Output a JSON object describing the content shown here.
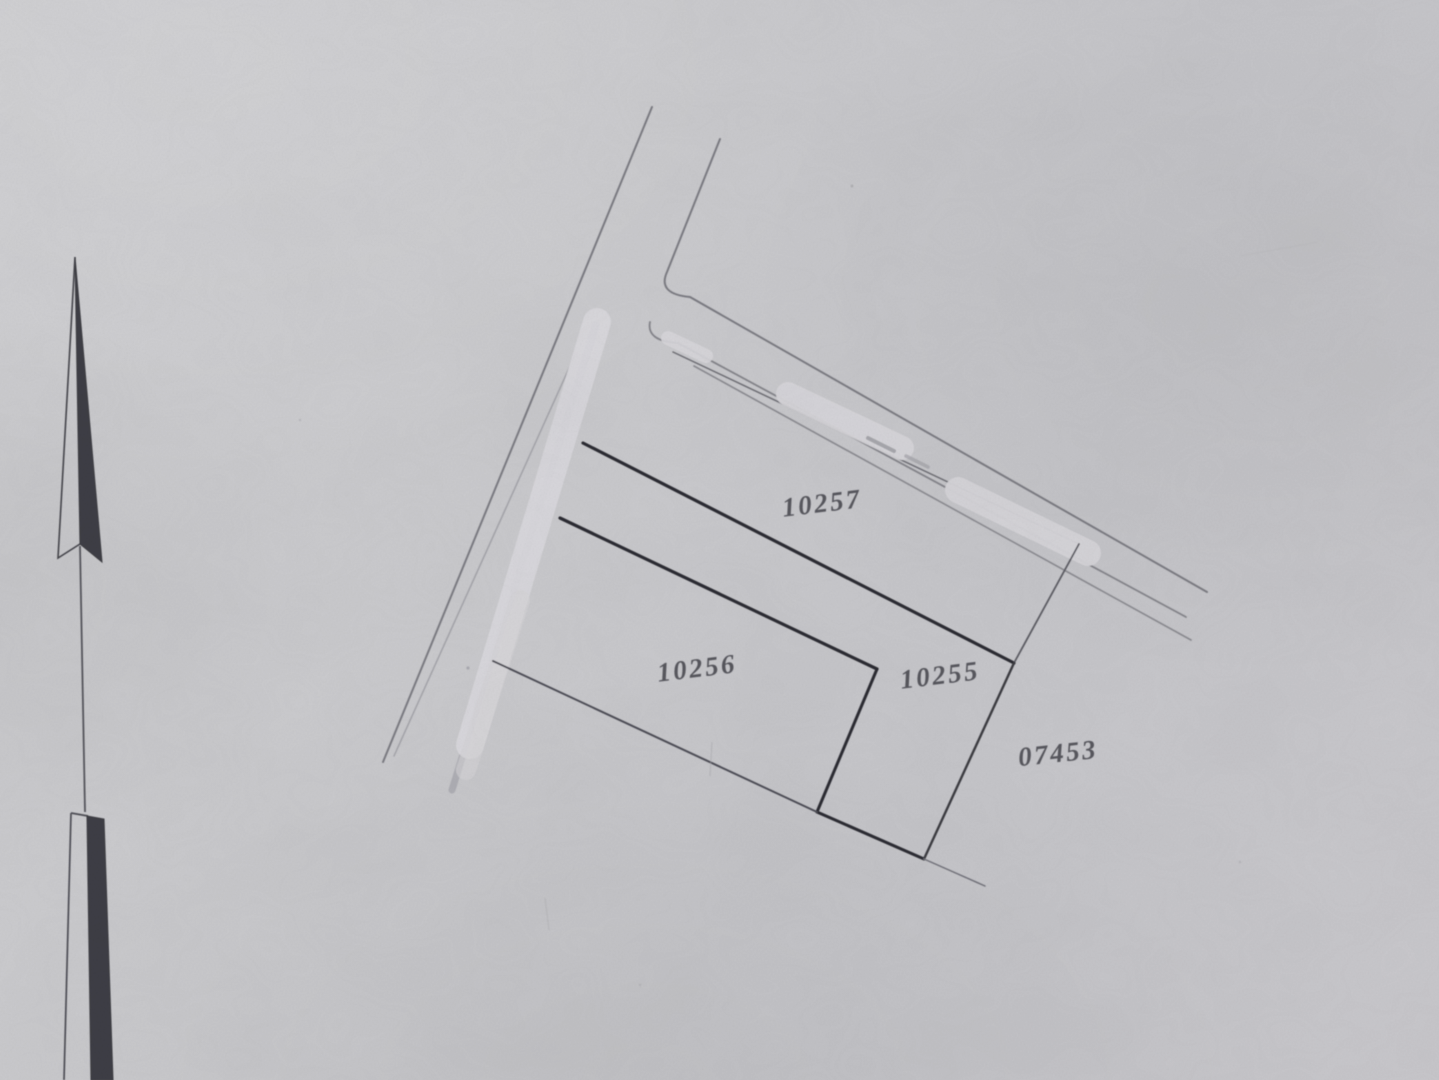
{
  "document": {
    "kind": "scanned cadastral site plan",
    "parcels": [
      {
        "label": "10257"
      },
      {
        "label": "10256"
      },
      {
        "label": "10255"
      },
      {
        "label": "07453"
      }
    ],
    "colors": {
      "paper": "#c9c9cc",
      "boundary_bold": "#2c2c32",
      "road_line": "#7b7b82",
      "label_ink": "#4b4b53",
      "whiteout": "#d8d7da",
      "north_arrow_fill": "#3e3e44"
    }
  }
}
